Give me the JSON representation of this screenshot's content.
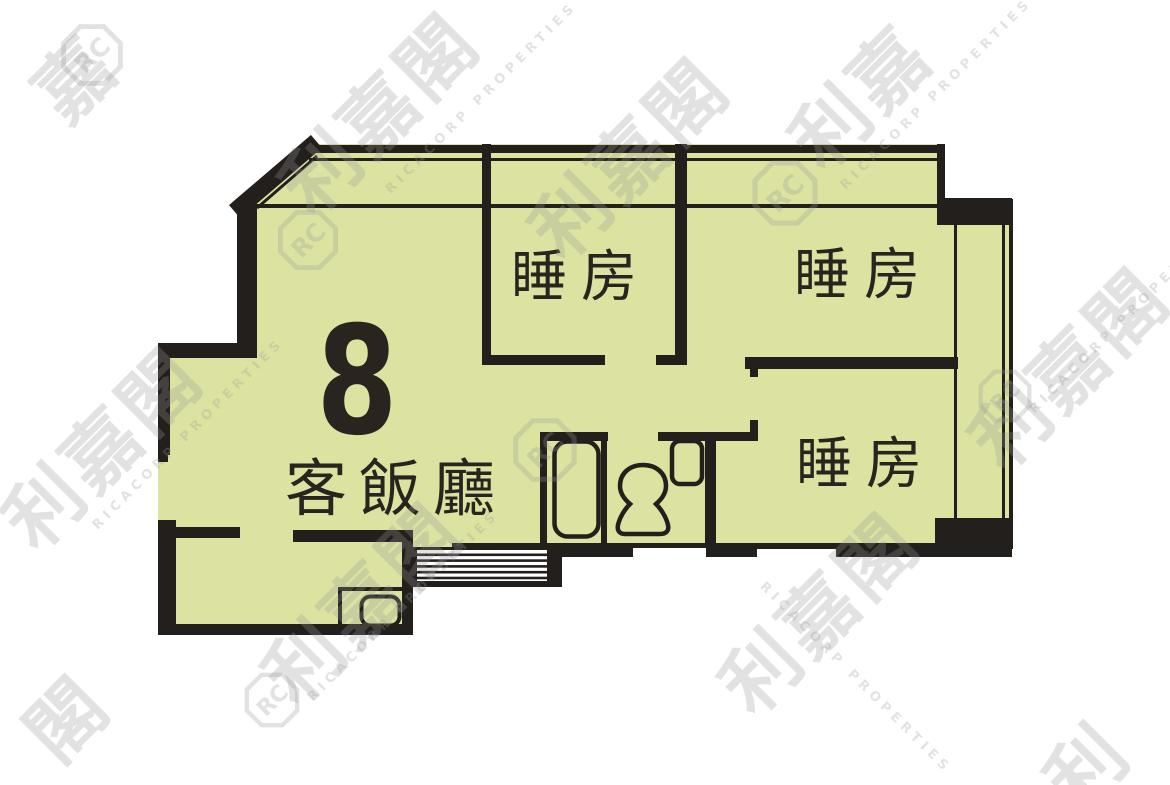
{
  "page": {
    "width": 1170,
    "height": 785,
    "background": "#ffffff"
  },
  "floorplan": {
    "unit_number": "8",
    "rooms": [
      {
        "id": "living-dining",
        "label": "客飯廳"
      },
      {
        "id": "bedroom-top-left",
        "label": "睡房"
      },
      {
        "id": "bedroom-top-right",
        "label": "睡房"
      },
      {
        "id": "bedroom-bottom-right",
        "label": "睡房"
      }
    ],
    "colors": {
      "floor_fill": "#dce3a0",
      "wall": "#231f1d",
      "label_text": "#2a2420",
      "watermark": "rgba(150,150,150,0.28)"
    }
  },
  "watermark": {
    "brand_cjk": "利嘉閣",
    "brand_en": "RICACORP PROPERTIES",
    "logo_monogram": "RC",
    "fragments": {
      "li": "利",
      "ka": "嘉",
      "kok": "閣",
      "lika": "利嘉",
      "kakok": "嘉閣"
    }
  }
}
